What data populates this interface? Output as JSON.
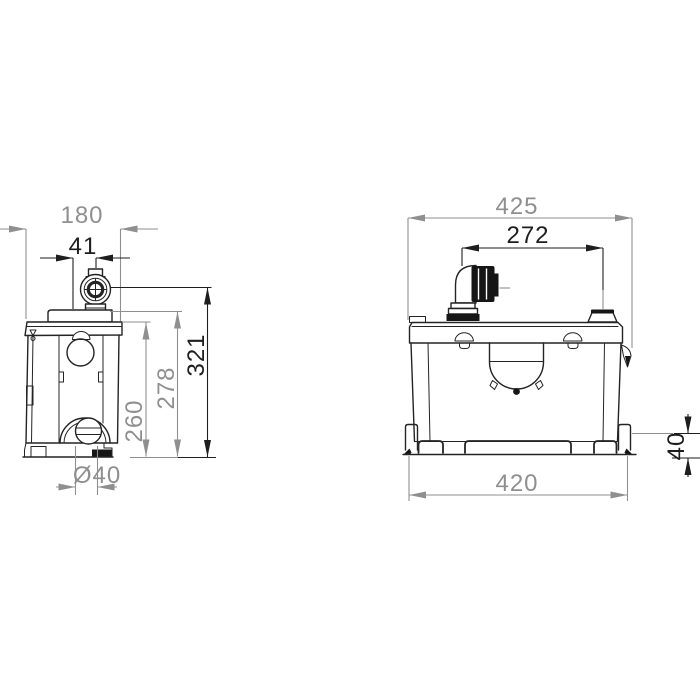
{
  "meta": {
    "description": "Technical dimensional drawing of a macerator pump unit, side view (left) and front view (right), dimensions in millimetres"
  },
  "colors": {
    "background": "#ffffff",
    "outline": "#242424",
    "dim_primary_black": "#1e1e1e",
    "dim_secondary_gray": "#8f8f8f",
    "solid_fill": "#161616"
  },
  "side_view": {
    "name": "side-view",
    "dimensions": {
      "overall_depth": "180",
      "outlet_offset": "41",
      "outlet_height": "321",
      "lid_height": "278",
      "body_height": "260",
      "inlet_diameter": "Ø40"
    }
  },
  "front_view": {
    "name": "front-view",
    "dimensions": {
      "overall_width": "425",
      "connection_spacing": "272",
      "base_height": "40",
      "base_width": "420"
    }
  }
}
